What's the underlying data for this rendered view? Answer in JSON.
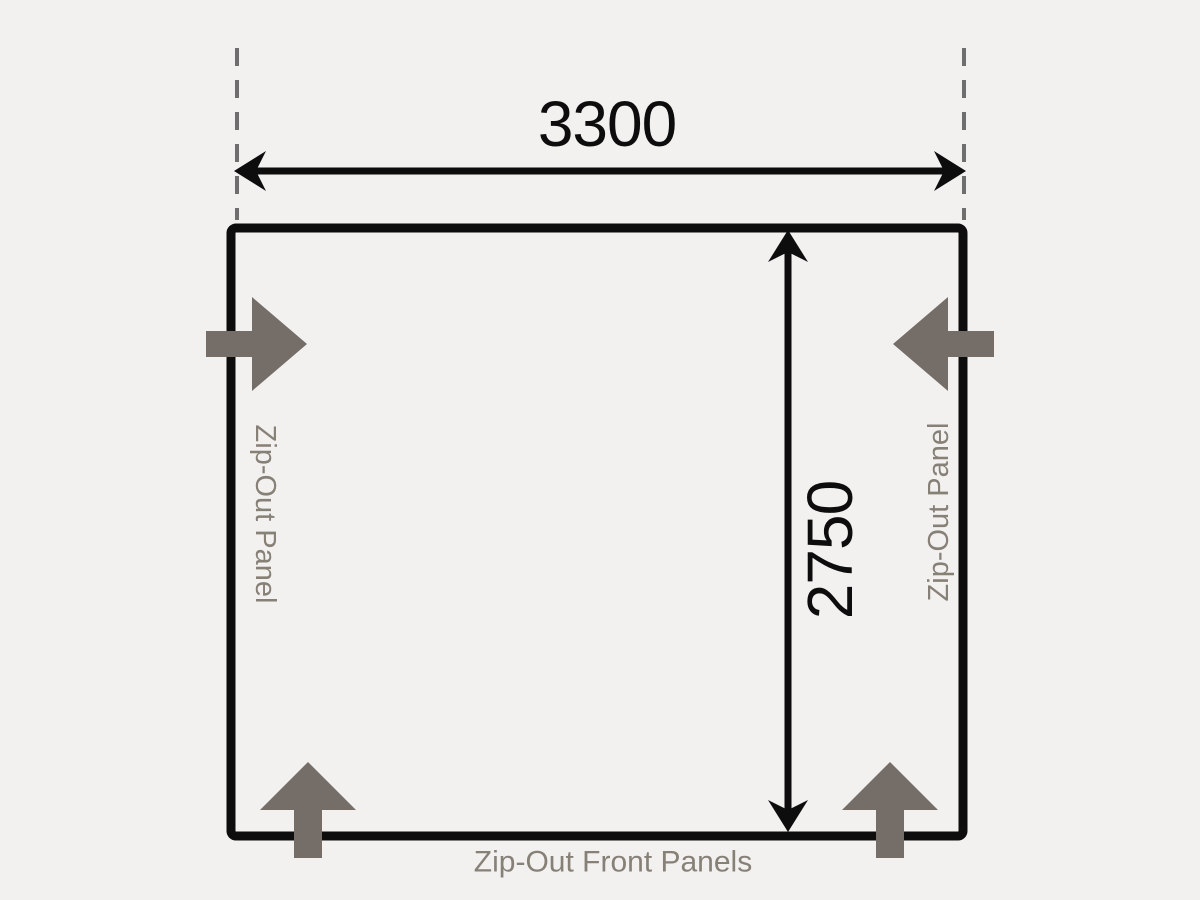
{
  "diagram": {
    "type": "awning-floorplan-dimension-diagram",
    "width_dimension": "3300",
    "depth_dimension": "2750",
    "labels": {
      "left_panel": "Zip-Out Panel",
      "right_panel": "Zip-Out Panel",
      "front_panels": "Zip-Out Front Panels"
    },
    "colors": {
      "background": "#f2f1ef",
      "line": "#0d0d0d",
      "block_arrow": "#756d68",
      "label_text": "#868077",
      "dashed_line": "#6e6e6e"
    }
  }
}
